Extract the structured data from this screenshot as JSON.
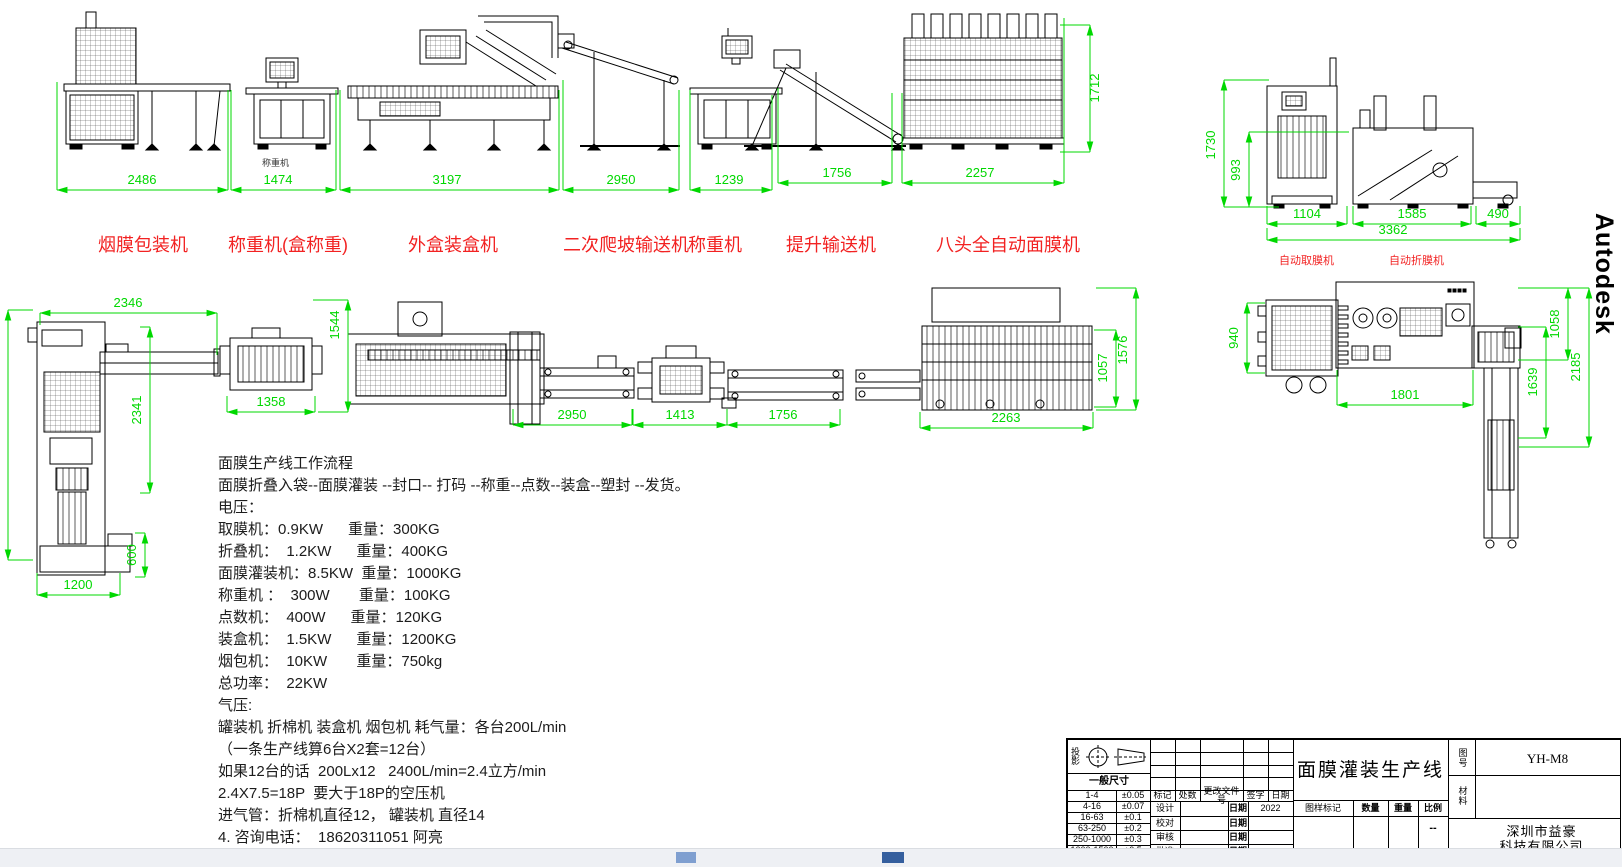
{
  "watermark": "Autodesk",
  "dim_color": "#00d800",
  "notes": {
    "x": 218,
    "y": 452,
    "line_height": 22,
    "lines": [
      "面膜生产线工作流程",
      "面膜折叠入袋--面膜灌装 --封口-- 打码 --称重--点数--装盒--塑封 --发货。",
      "电压：",
      "取膜机：0.9KW      重量：300KG",
      "折叠机：  1.2KW      重量：400KG",
      "面膜灌装机：8.5KW  重量：1000KG",
      "称重机 ：  300W       重量：100KG",
      "点数机：  400W      重量：120KG",
      "装盒机：  1.5KW      重量：1200KG",
      "烟包机：  10KW       重量：750kg",
      "总功率：  22KW",
      "气压:",
      "罐装机 折棉机 装盒机 烟包机 耗气量：各台200L/min",
      "（一条生产线算6台X2套=12台）",
      "如果12台的话  200Lx12   2400L/min=2.4立方/min",
      "2.4X7.5=18P  要大于18P的空压机",
      "进气管：折棉机直径12， 罐装机 直径14",
      "4. 咨询电话：  18620311051 阿亮"
    ]
  },
  "machine_labels": [
    {
      "text": "烟膜包装机",
      "x": 98,
      "y": 231,
      "size": 18,
      "color": "#f22222"
    },
    {
      "text": "称重机(盒称重)",
      "x": 228,
      "y": 231,
      "size": 18,
      "color": "#f22222"
    },
    {
      "text": "外盒装盒机",
      "x": 408,
      "y": 231,
      "size": 18,
      "color": "#f22222"
    },
    {
      "text": "二次爬坡输送机",
      "x": 563,
      "y": 231,
      "size": 18,
      "color": "#f22222"
    },
    {
      "text": "称重机",
      "x": 688,
      "y": 231,
      "size": 18,
      "color": "#f22222"
    },
    {
      "text": "提升输送机",
      "x": 786,
      "y": 231,
      "size": 18,
      "color": "#f22222"
    },
    {
      "text": "八头全自动面膜机",
      "x": 936,
      "y": 231,
      "size": 18,
      "color": "#f22222"
    },
    {
      "text": "自动取膜机",
      "x": 1279,
      "y": 252,
      "size": 11,
      "color": "#f22222"
    },
    {
      "text": "自动折膜机",
      "x": 1389,
      "y": 252,
      "size": 11,
      "color": "#f22222"
    },
    {
      "text": "称重机",
      "x": 262,
      "y": 156,
      "size": 9,
      "color": "#333333"
    }
  ],
  "dimensions": [
    {
      "t": "2486",
      "o": "h",
      "x1": 57,
      "x2": 228,
      "y": 190,
      "ea": -108,
      "eb": -100,
      "lx": 142,
      "ly": 184
    },
    {
      "t": "1474",
      "o": "h",
      "x1": 231,
      "x2": 336,
      "y": 190,
      "ea": -100,
      "eb": -100,
      "lx": 278,
      "ly": 184
    },
    {
      "t": "3197",
      "o": "h",
      "x1": 340,
      "x2": 559,
      "y": 190,
      "ea": -100,
      "eb": -100,
      "lx": 447,
      "ly": 184
    },
    {
      "t": "2950",
      "o": "h",
      "x1": 563,
      "x2": 679,
      "y": 190,
      "ea": -110,
      "eb": -100,
      "lx": 621,
      "ly": 184
    },
    {
      "t": "1239",
      "o": "h",
      "x1": 690,
      "x2": 772,
      "y": 190,
      "ea": -100,
      "eb": -95,
      "lx": 729,
      "ly": 184
    },
    {
      "t": "1756",
      "o": "h",
      "x1": 778,
      "x2": 892,
      "y": 183,
      "ea": -95,
      "eb": -90,
      "lx": 837,
      "ly": 177
    },
    {
      "t": "2257",
      "o": "h",
      "x1": 902,
      "x2": 1064,
      "y": 183,
      "ea": -90,
      "eb": -165,
      "lx": 980,
      "ly": 177
    },
    {
      "t": "1712",
      "o": "v",
      "x": 1090,
      "y1": 25,
      "y2": 152,
      "ea": -30,
      "eb": -30,
      "lx": 1099,
      "ly": 88
    },
    {
      "t": "1730",
      "o": "v",
      "x": 1224,
      "y1": 80,
      "y2": 207,
      "ea": 45,
      "eb": 45,
      "lx": 1215,
      "ly": 145
    },
    {
      "t": "993",
      "o": "v",
      "x": 1249,
      "y1": 132,
      "y2": 207,
      "ea": 100,
      "eb": 30,
      "lx": 1240,
      "ly": 170
    },
    {
      "t": "1104",
      "o": "h",
      "x1": 1267,
      "x2": 1347,
      "y": 224,
      "ea": -18,
      "eb": -18,
      "lx": 1307,
      "ly": 218
    },
    {
      "t": "1585",
      "o": "h",
      "x1": 1353,
      "x2": 1471,
      "y": 224,
      "ea": -18,
      "eb": -18,
      "lx": 1412,
      "ly": 218
    },
    {
      "t": "490",
      "o": "h",
      "x1": 1476,
      "x2": 1520,
      "y": 224,
      "ea": -18,
      "eb": -18,
      "lx": 1498,
      "ly": 218
    },
    {
      "t": "3362",
      "o": "h",
      "x1": 1267,
      "x2": 1520,
      "y": 240,
      "ea": -12,
      "eb": -12,
      "lx": 1393,
      "ly": 234
    },
    {
      "t": "2346",
      "o": "h",
      "x1": 40,
      "x2": 217,
      "y": 313,
      "ea": 12,
      "eb": 42,
      "lx": 128,
      "ly": 307
    },
    {
      "t": "2341",
      "o": "v",
      "x": 150,
      "y1": 327,
      "y2": 493,
      "ea": -10,
      "eb": -10,
      "lx": 141,
      "ly": 410
    },
    {
      "t": "600",
      "o": "v",
      "x": 145,
      "y1": 533,
      "y2": 577,
      "ea": -10,
      "eb": -10,
      "lx": 136,
      "ly": 555
    },
    {
      "t": "1200",
      "o": "h",
      "x1": 37,
      "x2": 120,
      "y": 595,
      "ea": -22,
      "eb": -22,
      "lx": 78,
      "ly": 589
    },
    {
      "t": "",
      "o": "v",
      "x": 8,
      "y1": 310,
      "y2": 560,
      "ea": 25,
      "eb": 25,
      "lx": 0,
      "ly": 0
    },
    {
      "t": "1358",
      "o": "h",
      "x1": 227,
      "x2": 315,
      "y": 412,
      "ea": -16,
      "eb": -16,
      "lx": 271,
      "ly": 406
    },
    {
      "t": "1544",
      "o": "v",
      "x": 348,
      "y1": 300,
      "y2": 412,
      "ea": -35,
      "eb": -30,
      "lx": 339,
      "ly": 325
    },
    {
      "t": "2950",
      "o": "h",
      "x1": 513,
      "x2": 632,
      "y": 425,
      "ea": -16,
      "eb": -16,
      "lx": 572,
      "ly": 419
    },
    {
      "t": "1413",
      "o": "h",
      "x1": 633,
      "x2": 727,
      "y": 425,
      "ea": -16,
      "eb": -16,
      "lx": 680,
      "ly": 419
    },
    {
      "t": "1756",
      "o": "h",
      "x1": 727,
      "x2": 840,
      "y": 425,
      "ea": -16,
      "eb": -16,
      "lx": 783,
      "ly": 419
    },
    {
      "t": "2263",
      "o": "h",
      "x1": 920,
      "x2": 1093,
      "y": 428,
      "ea": -16,
      "eb": -16,
      "lx": 1006,
      "ly": 422
    },
    {
      "t": "1057",
      "o": "v",
      "x": 1116,
      "y1": 330,
      "y2": 407,
      "ea": -22,
      "eb": -22,
      "lx": 1107,
      "ly": 368
    },
    {
      "t": "1576",
      "o": "v",
      "x": 1136,
      "y1": 288,
      "y2": 410,
      "ea": -40,
      "eb": -40,
      "lx": 1127,
      "ly": 350
    },
    {
      "t": "940",
      "o": "v",
      "x": 1247,
      "y1": 303,
      "y2": 373,
      "ea": 18,
      "eb": 18,
      "lx": 1238,
      "ly": 338
    },
    {
      "t": "1801",
      "o": "h",
      "x1": 1337,
      "x2": 1473,
      "y": 405,
      "ea": -35,
      "eb": -35,
      "lx": 1405,
      "ly": 399
    },
    {
      "t": "1639",
      "o": "v",
      "x": 1546,
      "y1": 327,
      "y2": 438,
      "ea": -28,
      "eb": -28,
      "lx": 1537,
      "ly": 382
    },
    {
      "t": "1058",
      "o": "v",
      "x": 1568,
      "y1": 288,
      "y2": 360,
      "ea": -50,
      "eb": -50,
      "lx": 1559,
      "ly": 324
    },
    {
      "t": "2185",
      "o": "v",
      "x": 1589,
      "y1": 288,
      "y2": 447,
      "ea": -70,
      "eb": -70,
      "lx": 1580,
      "ly": 367
    }
  ],
  "title_block": {
    "projection_label": "投影",
    "general_dim": "一般尺寸",
    "tol": [
      [
        "1-4",
        "±0.05"
      ],
      [
        "4-16",
        "±0.07"
      ],
      [
        "16-63",
        "±0.1"
      ],
      [
        "63-250",
        "±0.2"
      ],
      [
        "250-1000",
        "±0.3"
      ],
      [
        "1000-1500",
        "±0.5"
      ]
    ],
    "rev": [
      "标记",
      "处数",
      "更改文件号",
      "签字",
      "日期"
    ],
    "roles": [
      "设计",
      "校对",
      "审核",
      "批准"
    ],
    "date_label": "日期",
    "design_year": "2022",
    "drawing_mark_label": "图样标记",
    "title": "面膜灌装生产线",
    "attrs": [
      "数量",
      "重量",
      "比例"
    ],
    "scale": "--",
    "fig_no_label": "图号",
    "fig_no": "YH-M8",
    "material_label": "材料",
    "company1": "深圳市益豪",
    "company2": "科技有限公司"
  }
}
